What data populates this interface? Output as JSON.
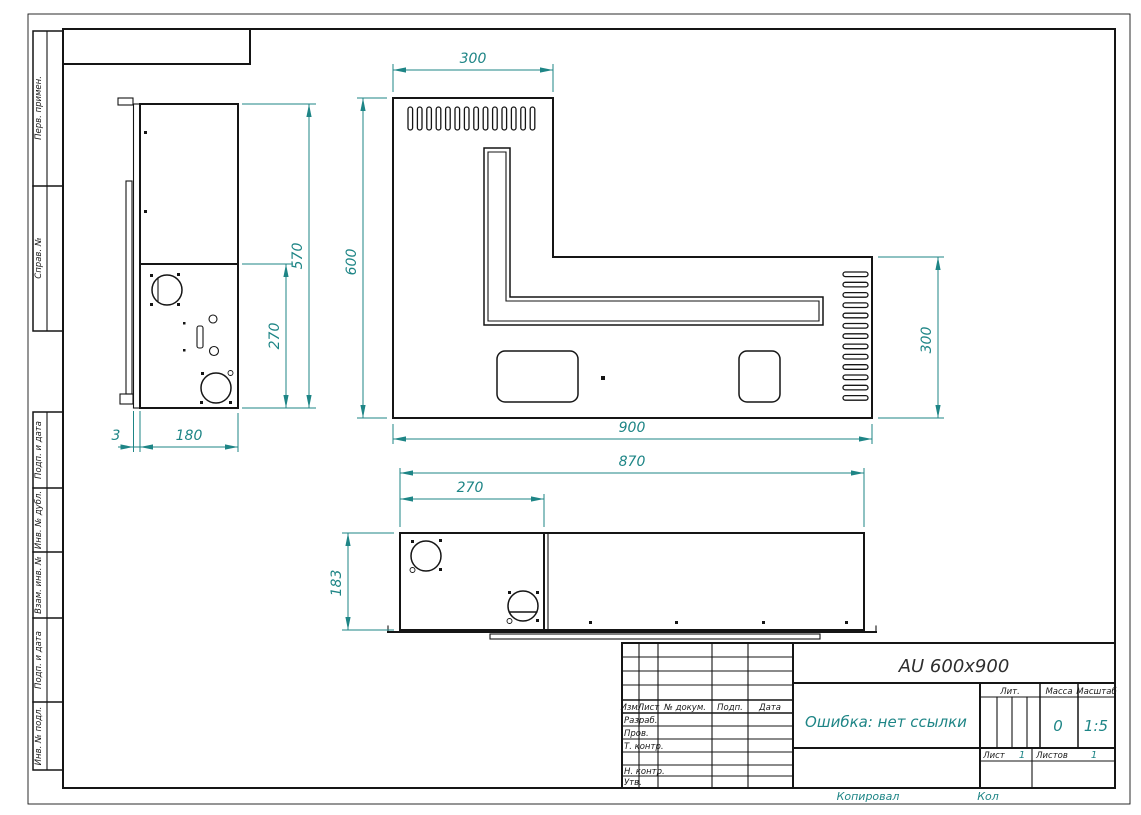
{
  "colors": {
    "dimension_accent": "#1e8586",
    "line": "#151515",
    "paper": "#ffffff"
  },
  "frame_labels": {
    "perv_primen": "Перв. примен.",
    "sprav_no": "Справ. №",
    "podp_i_data_1": "Подп. и дата",
    "inv_no_dubl": "Инв. № дубл.",
    "vzam_inv_no": "Взам. инв. №",
    "podp_i_data_2": "Подп. и дата",
    "inv_no_podl": "Инв. № подл."
  },
  "dimensions": {
    "main_top_width": "300",
    "main_height": "600",
    "main_right_height": "300",
    "main_width": "900",
    "side_height": "570",
    "side_lower_height": "270",
    "side_flange": "3",
    "side_depth": "180",
    "front_width": "870",
    "front_left_width": "270",
    "front_height": "183"
  },
  "title_block": {
    "doc_title": "AU 600x900",
    "doc_note": "Ошибка: нет ссылки",
    "col_izm": "Изм.",
    "col_list": "Лист",
    "col_docnum": "№ докум.",
    "col_podp": "Подп.",
    "col_data": "Дата",
    "row_razrab": "Разраб.",
    "row_prov": "Пров.",
    "row_tkontr": "Т. контр.",
    "row_nkontr": "Н. контр.",
    "row_utv": "Утв.",
    "lit_label": "Лит.",
    "massa_label": "Масса",
    "masshtab_label": "Масштаб",
    "massa_value": "0",
    "masshtab_value": "1:5",
    "list_label": "Лист",
    "list_value": "1",
    "listov_label": "Листов",
    "listov_value": "1",
    "kopiroval_label": "Копировал",
    "kol_label": "Кол"
  }
}
